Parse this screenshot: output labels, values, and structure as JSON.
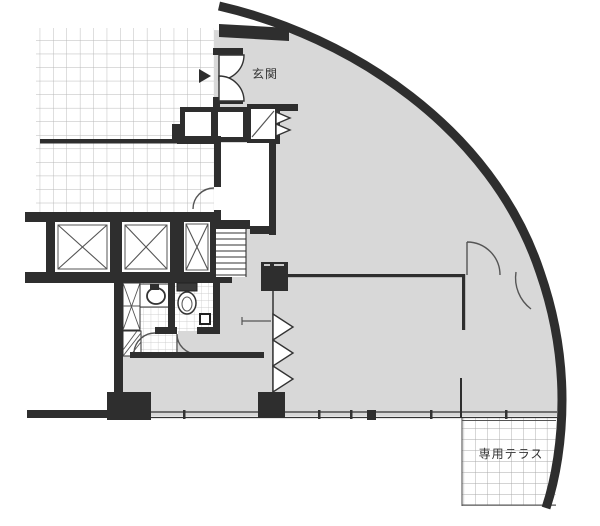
{
  "plan": {
    "labels": {
      "entrance": "玄関",
      "terrace": "専用テラス"
    },
    "colors": {
      "background": "#ffffff",
      "wall": "#2e2e2e",
      "room_fill": "#d8d8d8",
      "corridor_grid": "#b7b7b7",
      "tile_grid": "#c3c3c3",
      "terrace_grid": "#a8a8a8",
      "line": "#555555",
      "line_dark": "#333333",
      "text": "#333333"
    },
    "symbols": [
      "curved-exterior-wall",
      "entrance-double-door",
      "elevator",
      "staircase",
      "toilet",
      "washbasin",
      "door-swing",
      "folding-door",
      "duct-shaft",
      "column",
      "window-wall",
      "terrace-grid",
      "entry-direction-arrow"
    ]
  }
}
